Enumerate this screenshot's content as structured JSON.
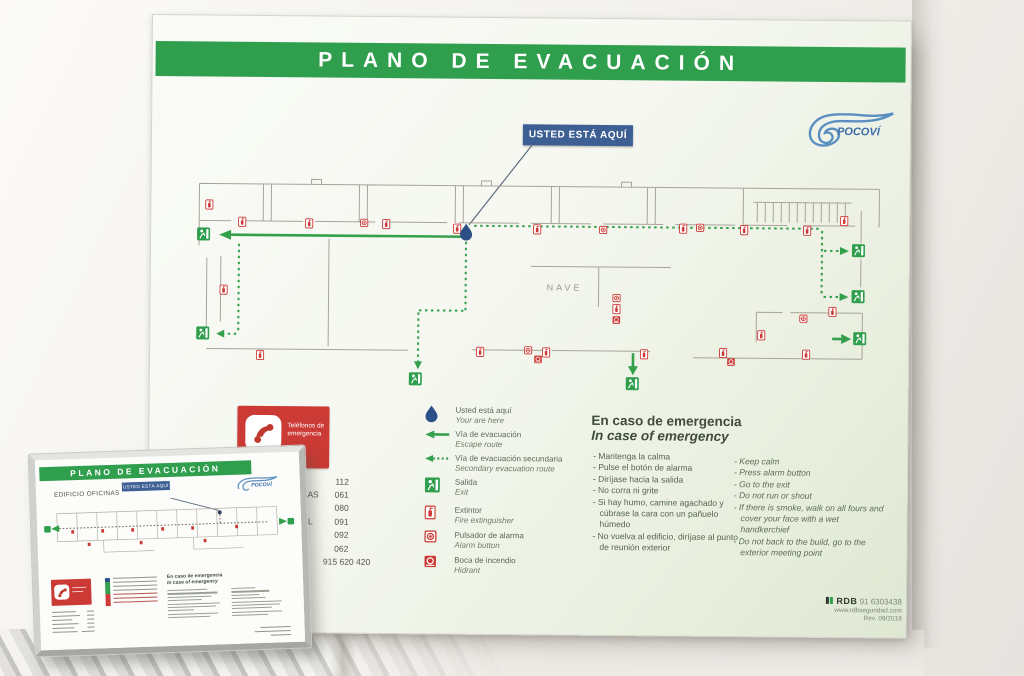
{
  "board": {
    "title": "PLANO DE EVACUACIÓN",
    "brand": "POCOVÍ",
    "you_are_here": "USTED ESTÁ AQUÍ",
    "plan": {
      "area_label": "NAVE"
    },
    "legend": [
      {
        "icon": "you-are-here-drop",
        "es": "Usted está aquí",
        "en": "Your are here"
      },
      {
        "icon": "escape-route-arrow",
        "es": "Vía de evacuación",
        "en": "Escape route"
      },
      {
        "icon": "secondary-route-arrow",
        "es": "Vía de evacuación secundaria",
        "en": "Secondary evacuation route"
      },
      {
        "icon": "exit-sign",
        "es": "Salida",
        "en": "Exit"
      },
      {
        "icon": "fire-extinguisher",
        "es": "Extintor",
        "en": "Fire extinguisher"
      },
      {
        "icon": "alarm-button",
        "es": "Pulsador de alarma",
        "en": "Alarm button"
      },
      {
        "icon": "fire-hydrant",
        "es": "Boca de incendio",
        "en": "Hidrant"
      }
    ],
    "phones": {
      "box_line1": "Teléfonos de",
      "box_line2": "emergencia",
      "visible_fragment_1": "CAS",
      "visible_fragment_2": "L",
      "numbers": [
        "112",
        "061",
        "080",
        "091",
        "092",
        "062",
        "915 620 420"
      ]
    },
    "instructions": {
      "heading_es": "En caso de emergencia",
      "heading_en": "In case of emergency",
      "es": [
        "Mantenga la calma",
        "Pulse el botón de alarma",
        "Diríjase hacia la salida",
        "No corra ni grite",
        "Si hay humo, camine agachado y cúbrase la cara con un pañuelo húmedo",
        "No vuelva al edificio, diríjase al punto de reunión exterior"
      ],
      "en": [
        "Keep calm",
        "Press alarm button",
        "Go to the exit",
        "Do not run or shout",
        "If there is smoke, walk on all fours and cover your face with a wet handkerchief",
        "Do not back to the build, go to the exterior meeting point"
      ]
    },
    "footer": {
      "maker": "RDB",
      "phone": "91 6303438",
      "web": "www.rdbseguridad.com",
      "rev": "Rev. 09/2018"
    }
  },
  "small_sign": {
    "title": "PLANO DE EVACUACIÓN",
    "subtitle": "EDIFICIO OFICINAS",
    "you_are_here": "USTED ESTÁ AQUÍ",
    "brand": "POCOVÍ"
  },
  "colors": {
    "green": "#2f9e4d",
    "route_green": "#35a04c",
    "red": "#cc3a35",
    "blue_box": "#3d5f94",
    "drop_blue": "#2b4f86"
  }
}
